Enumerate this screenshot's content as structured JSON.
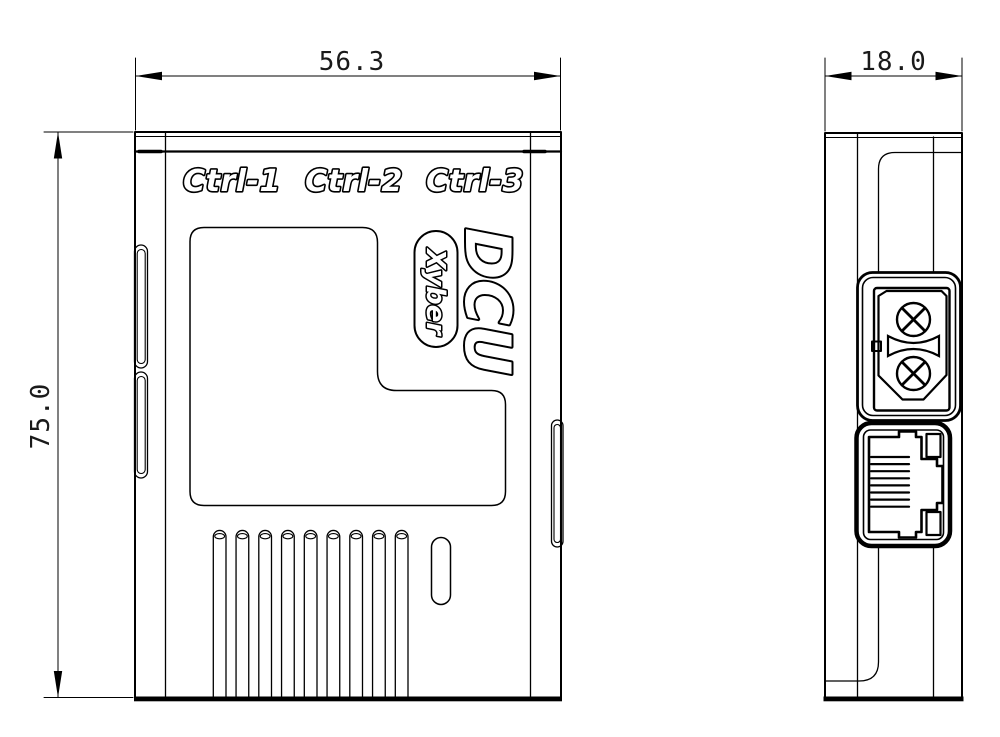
{
  "drawing": {
    "background": "#ffffff",
    "line_color": "#000000",
    "front_view": {
      "port_labels": [
        "Ctrl-1",
        "Ctrl-2",
        "Ctrl-3"
      ],
      "logo": "DCU",
      "brand": "Xyber",
      "width_dim": "56.3",
      "height_dim": "75.0",
      "vent_slot_count": 9
    },
    "side_view": {
      "depth_dim": "18.0",
      "port_icons": [
        "xt30-power-connector-icon",
        "rj45-ethernet-port-icon"
      ]
    }
  }
}
